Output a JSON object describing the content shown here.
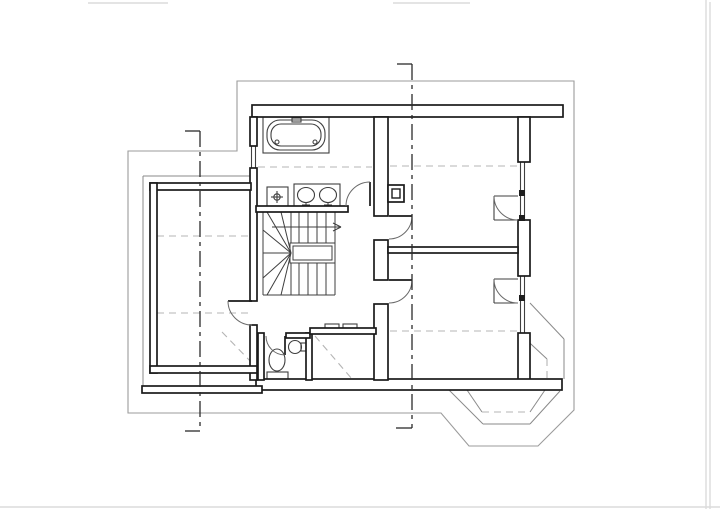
{
  "document": {
    "kind": "scanned architectural floor plan, attic storey, no text labels",
    "canvas": {
      "width": 720,
      "height": 509
    },
    "colors": {
      "paper": "#ffffff",
      "wall_line": "#1a1a1a",
      "fixture_line": "#3f3f3f",
      "eaves_line": "#9b9b9b",
      "dashed_ceiling_line": "#b4b4b4",
      "axis_line": "#2b2b2b",
      "scan_artifact": "#dcdcdc"
    }
  },
  "plan": {
    "layers": [
      {
        "name": "scan-artifacts",
        "cls": "ln-art",
        "els": [
          [
            "l",
            88,
            3,
            168,
            3,
            "scan-mark-top-left"
          ],
          [
            "l",
            393,
            3,
            470,
            3,
            "scan-mark-top-center"
          ],
          [
            "l",
            706,
            0,
            706,
            509,
            "paper-edge-right-inner"
          ],
          [
            "l",
            710,
            2,
            710,
            509,
            "paper-edge-right-outer"
          ],
          [
            "l",
            0,
            507,
            720,
            507,
            "paper-edge-bottom"
          ]
        ]
      },
      {
        "name": "eaves-outline",
        "cls": "ln-eaves",
        "els": [
          [
            "p",
            "M237 81 L574 81 L574 410 L538 446 L469 446 L441 413 L128 413 L128 151 L237 151 Z",
            "eaves-roof-outline"
          ]
        ]
      },
      {
        "name": "lower-storey-outlines",
        "cls": "ln-bay",
        "els": [
          [
            "l",
            143,
            176,
            257,
            176,
            "left-block-outer-face-top"
          ],
          [
            "l",
            143,
            176,
            143,
            389,
            "left-block-outer-face-left"
          ],
          [
            "l",
            467,
            390,
            482,
            412,
            "bay-inner-side-left"
          ],
          [
            "l",
            545,
            390,
            530,
            412,
            "bay-inner-side-right"
          ],
          [
            "l",
            449,
            390,
            483,
            424,
            "bay-mid-side-left"
          ],
          [
            "l",
            483,
            424,
            530,
            424,
            "bay-mid-bottom"
          ],
          [
            "l",
            530,
            424,
            560,
            391,
            "bay-mid-side-right"
          ],
          [
            "l",
            530,
            303,
            564,
            339,
            "se-chamfer-outer-line"
          ],
          [
            "l",
            519,
            333,
            547,
            359,
            "se-chamfer-inner-line"
          ],
          [
            "l",
            564,
            339,
            564,
            379,
            "se-corner-vertical-line"
          ]
        ]
      },
      {
        "name": "ceiling-height-dashed-lines",
        "cls": "ln-dash",
        "els": [
          [
            "l",
            258,
            167,
            372,
            167,
            "bathroom-knee-line"
          ],
          [
            "l",
            390,
            166,
            518,
            166,
            "ne-room-knee-line"
          ],
          [
            "l",
            157,
            236,
            250,
            236,
            "left-room-knee-line-upper"
          ],
          [
            "l",
            157,
            313,
            250,
            313,
            "left-room-knee-line-lower"
          ],
          [
            "l",
            390,
            331,
            518,
            331,
            "se-room-knee-line"
          ],
          [
            "l",
            315,
            336,
            352,
            379,
            "south-room-valley-line"
          ],
          [
            "l",
            222,
            332,
            255,
            366,
            "left-room-valley-line"
          ],
          [
            "l",
            482,
            412,
            530,
            412,
            "bay-inner-bottom-dashed"
          ],
          [
            "l",
            547,
            359,
            547,
            379,
            "se-chamfer-dashed-vertical"
          ]
        ]
      },
      {
        "name": "staircase",
        "cls": "ln-stair",
        "els": [
          [
            "l",
            263,
            212,
            263,
            295,
            "stair-outer-string-left"
          ],
          [
            "l",
            263,
            295,
            335,
            295,
            "stair-bottom-edge"
          ],
          [
            "l",
            335,
            212,
            335,
            295,
            "stair-right-edge"
          ],
          [
            "l",
            291,
            212,
            291,
            243,
            "stair-tread-t0"
          ],
          [
            "l",
            299,
            212,
            299,
            243,
            "stair-tread-t1"
          ],
          [
            "l",
            308,
            212,
            308,
            243,
            "stair-tread-t2"
          ],
          [
            "l",
            317,
            212,
            317,
            243,
            "stair-tread-t3"
          ],
          [
            "l",
            326,
            212,
            326,
            243,
            "stair-tread-t4"
          ],
          [
            "l",
            291,
            263,
            291,
            295,
            "stair-tread-b0"
          ],
          [
            "l",
            299,
            263,
            299,
            295,
            "stair-tread-b1"
          ],
          [
            "l",
            308,
            263,
            308,
            295,
            "stair-tread-b2"
          ],
          [
            "l",
            317,
            263,
            317,
            295,
            "stair-tread-b3"
          ],
          [
            "l",
            326,
            263,
            326,
            295,
            "stair-tread-b4"
          ],
          [
            "l",
            263,
            253,
            291,
            253,
            "stair-winder-mid"
          ],
          [
            "l",
            291,
            253,
            263,
            230,
            "stair-winder-u1"
          ],
          [
            "l",
            291,
            253,
            267,
            212,
            "stair-winder-u2"
          ],
          [
            "l",
            291,
            253,
            281,
            212,
            "stair-winder-u3"
          ],
          [
            "l",
            291,
            253,
            263,
            278,
            "stair-winder-d1"
          ],
          [
            "l",
            291,
            253,
            267,
            295,
            "stair-winder-d2"
          ],
          [
            "l",
            291,
            253,
            281,
            295,
            "stair-winder-d3"
          ],
          [
            "r",
            290,
            243,
            45,
            20,
            "stair-void-outer"
          ],
          [
            "r",
            293,
            246,
            39,
            14,
            "stair-void-inner"
          ],
          [
            "l",
            272,
            227,
            340,
            227,
            "stair-direction-line"
          ],
          [
            "l",
            333,
            223,
            341,
            227,
            "stair-arrowhead-upper"
          ],
          [
            "l",
            333,
            231,
            341,
            227,
            "stair-arrowhead-lower"
          ]
        ]
      },
      {
        "name": "fixtures",
        "cls": "ln-fix",
        "els": [
          [
            "r",
            263,
            117,
            66,
            36,
            "bathtub-platform"
          ],
          [
            "rr",
            267,
            120,
            58,
            30,
            13,
            "bathtub-rim"
          ],
          [
            "rr",
            271,
            124,
            50,
            22,
            10,
            "bathtub-basin"
          ],
          [
            "r",
            292,
            118,
            9,
            4,
            "bathtub-faucet"
          ],
          [
            "c",
            277,
            142,
            2,
            "bathtub-jet-left"
          ],
          [
            "c",
            315,
            142,
            2,
            "bathtub-jet-right"
          ],
          [
            "r",
            294,
            184,
            46,
            23,
            "vanity-counter"
          ],
          [
            "e",
            306,
            195,
            8.5,
            7.5,
            "vanity-basin-left"
          ],
          [
            "e",
            328,
            195,
            8.5,
            7.5,
            "vanity-basin-right"
          ],
          [
            "l",
            306,
            202,
            306,
            208,
            "vanity-tap-left-stem"
          ],
          [
            "l",
            302,
            205,
            310,
            205,
            "vanity-tap-left-bar"
          ],
          [
            "l",
            328,
            202,
            328,
            208,
            "vanity-tap-right-stem"
          ],
          [
            "l",
            324,
            205,
            332,
            205,
            "vanity-tap-right-bar"
          ],
          [
            "r",
            267,
            187,
            21,
            21,
            "shower-fixture-box"
          ],
          [
            "c",
            277,
            197,
            3.2,
            "shower-drain"
          ],
          [
            "l",
            277,
            191,
            277,
            203,
            "shower-cross-vertical"
          ],
          [
            "l",
            271,
            197,
            283,
            197,
            "shower-cross-horizontal"
          ],
          [
            "e",
            277,
            360,
            8,
            11,
            "toilet-bowl"
          ],
          [
            "r",
            267,
            372,
            21,
            8,
            "toilet-tank"
          ],
          [
            "c",
            295,
            347,
            6.5,
            "wc-corner-sink"
          ],
          [
            "r",
            301,
            343,
            6,
            8,
            "wc-sink-tap"
          ],
          [
            "r",
            325,
            324,
            14,
            5,
            "south-room-sill-mark-left"
          ],
          [
            "r",
            343,
            324,
            14,
            5,
            "south-room-sill-mark-right"
          ],
          [
            "l",
            251.5,
            146,
            251.5,
            168,
            "bath-window-glazing-outer"
          ],
          [
            "l",
            255.5,
            146,
            255.5,
            168,
            "bath-window-glazing-inner"
          ],
          [
            "l",
            520.5,
            162,
            520.5,
            220,
            "east-window1-glazing-outer"
          ],
          [
            "l",
            524.5,
            162,
            524.5,
            220,
            "east-window1-glazing-inner"
          ],
          [
            "l",
            520.5,
            276,
            520.5,
            333,
            "east-window2-glazing-outer"
          ],
          [
            "l",
            524.5,
            276,
            524.5,
            333,
            "east-window2-glazing-inner"
          ],
          [
            "l",
            494,
            196,
            518,
            196,
            "casement1-reveal-top"
          ],
          [
            "l",
            494,
            220,
            518,
            220,
            "casement1-reveal-bottom"
          ],
          [
            "l",
            494,
            196,
            494,
            220,
            "casement1-reveal-side"
          ],
          [
            "l",
            494,
            279,
            518,
            279,
            "casement2-reveal-top"
          ],
          [
            "l",
            494,
            303,
            518,
            303,
            "casement2-reveal-bottom"
          ],
          [
            "l",
            494,
            279,
            494,
            303,
            "casement2-reveal-side"
          ]
        ]
      },
      {
        "name": "walls",
        "cls": "wall",
        "els": [
          [
            "r",
            252,
            105,
            311,
            12,
            "north-exterior-wall"
          ],
          [
            "r",
            518,
            117,
            12,
            45,
            "east-exterior-wall-upper"
          ],
          [
            "r",
            518,
            220,
            12,
            56,
            "east-exterior-wall-middle"
          ],
          [
            "r",
            518,
            333,
            12,
            47,
            "east-exterior-wall-lower"
          ],
          [
            "r",
            256,
            379,
            306,
            11,
            "south-exterior-wall"
          ],
          [
            "r",
            142,
            386,
            120,
            7,
            "left-block-outer-south-wall"
          ],
          [
            "r",
            250,
            117,
            7,
            29,
            "bathroom-west-wall"
          ],
          [
            "r",
            250,
            168,
            7,
            133,
            "west-shared-wall"
          ],
          [
            "r",
            250,
            325,
            7,
            55,
            "west-shared-wall-lower"
          ],
          [
            "r",
            150,
            183,
            101,
            7,
            "left-room-north-wall"
          ],
          [
            "r",
            150,
            183,
            7,
            190,
            "left-room-west-wall"
          ],
          [
            "r",
            150,
            366,
            107,
            7,
            "left-room-south-wall"
          ],
          [
            "r",
            256,
            206,
            92,
            6,
            "bathroom-south-wall"
          ],
          [
            "r",
            374,
            117,
            14,
            99,
            "hall-east-wall-upper"
          ],
          [
            "r",
            374,
            240,
            14,
            40,
            "hall-east-wall-middle"
          ],
          [
            "r",
            374,
            304,
            14,
            76,
            "hall-east-wall-lower"
          ],
          [
            "r",
            388,
            247,
            130,
            6,
            "east-rooms-dividing-wall"
          ],
          [
            "r",
            258,
            333,
            6,
            47,
            "wc-west-wall"
          ],
          [
            "r",
            306,
            333,
            6,
            47,
            "wc-east-wall"
          ],
          [
            "r",
            286,
            333,
            24,
            5,
            "wc-north-wall"
          ],
          [
            "r",
            310,
            328,
            66,
            6,
            "south-middle-room-north-wall"
          ],
          [
            "r",
            388,
            185,
            16,
            17,
            "chimney-body"
          ]
        ]
      },
      {
        "name": "wall-details",
        "cls": "box",
        "els": [
          [
            "r",
            392,
            189,
            8,
            9,
            "chimney-flue"
          ]
        ]
      },
      {
        "name": "window-stops",
        "cls": "solid",
        "els": [
          [
            "r",
            519,
            190,
            6,
            6,
            "east-window1-mullion-upper"
          ],
          [
            "r",
            519,
            215,
            6,
            6,
            "east-window1-mullion-lower"
          ],
          [
            "r",
            519,
            295,
            6,
            6,
            "east-window2-mullion"
          ]
        ]
      },
      {
        "name": "doors",
        "cls": "doors",
        "els": [
          [
            "l",
            370,
            206,
            370,
            182,
            "bathroom-door-leaf"
          ],
          [
            "p",
            "M346 206 A24 24 0 0 1 370 182",
            "bathroom-door-swing-arc"
          ],
          [
            "l",
            389,
            216,
            412,
            216,
            "ne-room-door-leaf"
          ],
          [
            "p",
            "M412 216 A23 23 0 0 1 389 239",
            "ne-room-door-swing-arc"
          ],
          [
            "l",
            389,
            280,
            412,
            280,
            "se-room-door-leaf"
          ],
          [
            "p",
            "M412 280 A23 23 0 0 1 389 303",
            "se-room-door-swing-arc"
          ],
          [
            "l",
            252,
            301,
            228,
            301,
            "left-room-door-leaf"
          ],
          [
            "p",
            "M228 301 A24 24 0 0 0 252 325",
            "left-room-door-swing-arc"
          ],
          [
            "l",
            285,
            336,
            285,
            355,
            "wc-door-leaf"
          ],
          [
            "p",
            "M266 336 A19 19 0 0 0 285 355",
            "wc-door-swing-arc"
          ],
          [
            "p",
            "M494 196 A24 24 0 0 0 518 220",
            "casement1-swing-arc"
          ],
          [
            "p",
            "M494 279 A24 24 0 0 0 518 303",
            "casement2-swing-arc"
          ]
        ]
      },
      {
        "name": "axis-centerlines",
        "cls": "ln-center",
        "els": [
          [
            "l",
            200,
            131,
            200,
            431,
            "axis-line-left",
            "axis"
          ],
          [
            "l",
            185,
            131,
            200,
            131,
            "axis-left-hook-top",
            "hook"
          ],
          [
            "l",
            185,
            431,
            200,
            431,
            "axis-left-hook-bottom",
            "hook"
          ],
          [
            "l",
            412,
            64,
            412,
            428,
            "axis-line-right",
            "axis"
          ],
          [
            "l",
            397,
            64,
            412,
            64,
            "axis-right-hook-top",
            "hook"
          ],
          [
            "l",
            396,
            428,
            412,
            428,
            "axis-right-hook-bottom",
            "hook"
          ]
        ]
      }
    ]
  }
}
